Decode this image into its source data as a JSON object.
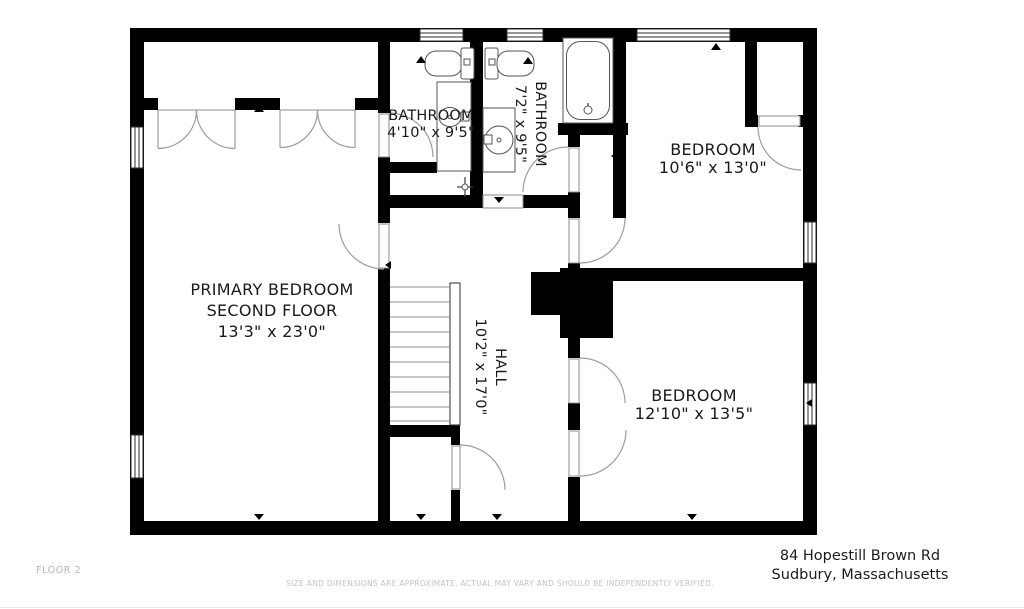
{
  "plan": {
    "floor_label": "FLOOR 2",
    "rooms": {
      "primary_bedroom": {
        "name_line1": "PRIMARY BEDROOM",
        "name_line2": "SECOND FLOOR",
        "dims": "13'3\" x 23'0\""
      },
      "bathroom_small": {
        "name": "BATHROOM",
        "dims": "4'10\" x 9'5\""
      },
      "bathroom_large": {
        "name": "BATHROOM",
        "dims": "7'2\" x 9'5\""
      },
      "bedroom_top": {
        "name": "BEDROOM",
        "dims": "10'6\" x 13'0\""
      },
      "bedroom_bottom": {
        "name": "BEDROOM",
        "dims": "12'10\" x 13'5\""
      },
      "hall": {
        "name": "HALL",
        "dims": "10'2\" x 17'0\""
      }
    },
    "fixtures": [
      "toilet",
      "toilet",
      "vanity-sink",
      "round-sink",
      "bathtub",
      "shower-valve",
      "stairs",
      "chimney"
    ]
  },
  "footer": {
    "disclaimer": "SIZE AND DIMENSIONS ARE APPROXIMATE, ACTUAL MAY VARY AND SHOULD BE INDEPENDENTLY VERIFIED.",
    "address_line1": "84 Hopestill Brown Rd",
    "address_line2": "Sudbury, Massachusetts"
  },
  "colors": {
    "wall": "#000000",
    "door_swing": "#9c9c9c",
    "label_text": "#1a1a1a",
    "muted_text": "#c4c4c4",
    "background": "#ffffff"
  }
}
